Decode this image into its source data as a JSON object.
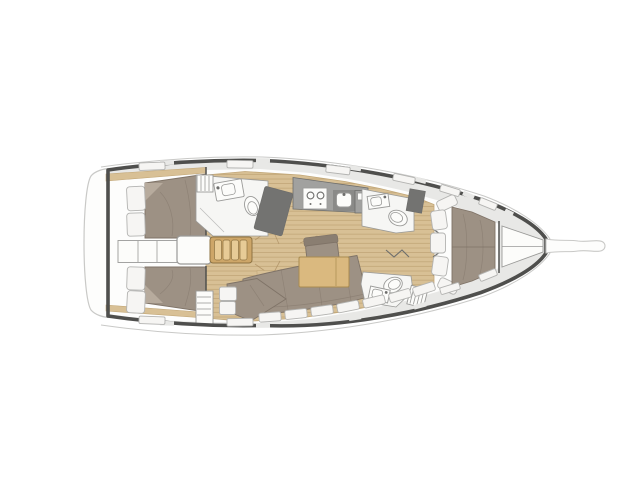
{
  "canvas": {
    "width": 640,
    "height": 479,
    "background": "#ffffff"
  },
  "diagram": {
    "type": "floor-plan",
    "subject": "sailing yacht interior layout, top-down view",
    "orientation": "bow-right, stern-left",
    "regions": [
      "swim-platform",
      "aft-cabin-port",
      "aft-cabin-starboard",
      "companionway-stairs",
      "engine-compartment",
      "aft-head",
      "nav-station",
      "galley",
      "saloon",
      "forward-head-port",
      "forward-head-starboard",
      "forward-cabin",
      "anchor-locker",
      "bowsprit"
    ],
    "fixtures": [
      "double-berth",
      "pillows",
      "two-burner-stove",
      "galley-sink",
      "toilet",
      "washbasin",
      "dining-table",
      "u-shaped-settee",
      "chaise-seat",
      "armchair",
      "v-berth",
      "hull-cushions",
      "deck-hatches",
      "hull-windows",
      "accordion-doors"
    ]
  },
  "palette": {
    "bg": "#ffffff",
    "rail": "#c9c9c7",
    "hull": "#4f4f4d",
    "deck": "#e8e8e6",
    "floor": "#fdfdfc",
    "headfloor": "#f6f6f4",
    "wood": "#d8c095",
    "woodline": "#c2a778",
    "wooddark": "#a8895c",
    "stair": "#cda668",
    "stairstep": "#e7cb96",
    "stairline": "#8e7342",
    "furnwood": "#dab97f",
    "furnline": "#a98c50",
    "bed": "#9d9184",
    "bedfold": "#b7ab9d",
    "beddark": "#8a7e71",
    "bedline": "#7f7367",
    "cushion": "#f6f5f3",
    "cushionline": "#b3b3b1",
    "counter": "#a1a19f",
    "counterdark": "#8a8a88",
    "counterline": "#6e6e6c",
    "nav": "#737371",
    "fixwhite": "#fcfcfa",
    "fixline": "#9a9a98"
  }
}
